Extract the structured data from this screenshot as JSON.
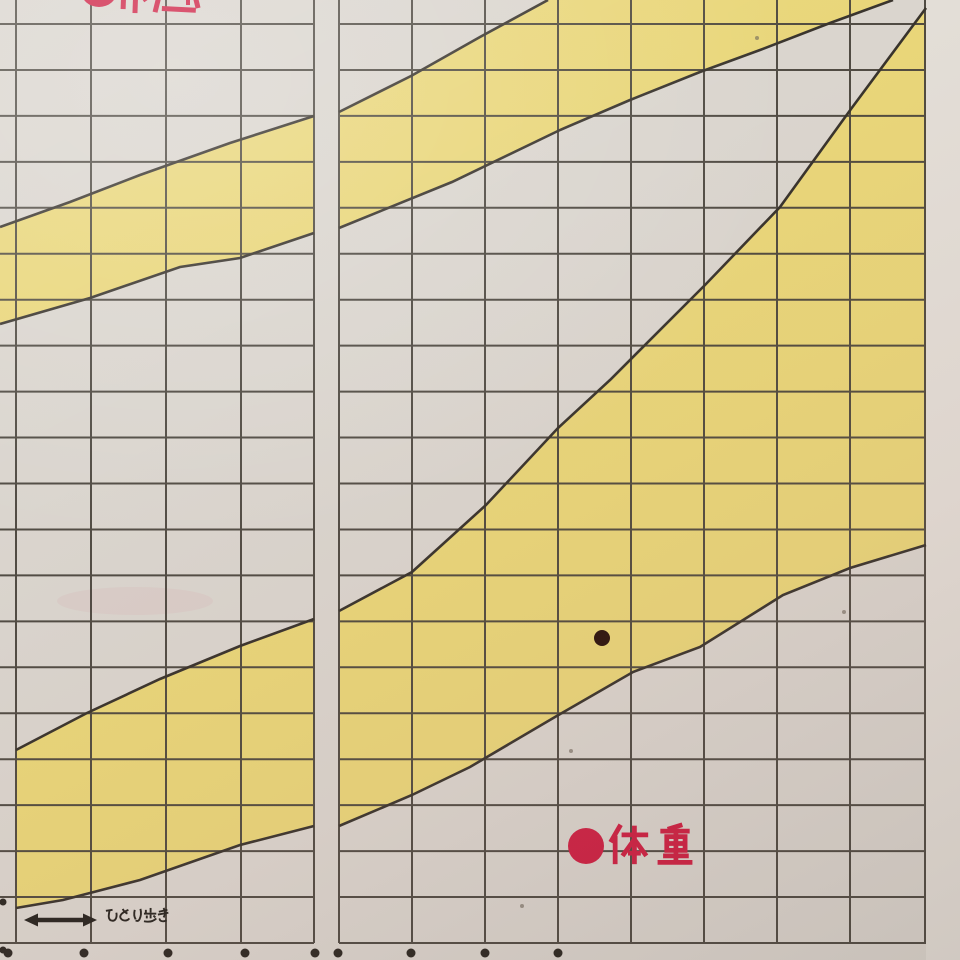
{
  "scene": {
    "description": "Photograph of a printed Japanese child growth chart page (percentile band chart)",
    "kind": "growth-chart-photo"
  },
  "labels": {
    "height_label": "●身長",
    "height_label_state": "cropped at top edge of photo, only bottom tips of red characters visible",
    "weight_bullet": "●",
    "weight_label": "体重",
    "walking_label": "ひとり歩き"
  },
  "colors": {
    "paper": "#dad5ce",
    "paper_margin": "#e3ded7",
    "band_yellow": "#e9d679",
    "grid_line": "#49443c",
    "band_edge": "#38332c",
    "accent_red": "#ce2043",
    "plot_dot": "#2a120b",
    "ink_dark": "#26231e",
    "tick_dot": "#2b2721",
    "smudge_pink": "#d46a7a"
  },
  "chart_data": {
    "type": "area",
    "title": "",
    "note": "Two diagonal yellow percentile bands: upper = height (身長), lower = weight (体重). One plotted measurement dot inside the weight band. Numeric axis labels fall outside the photo crop.",
    "units": "pixel coordinates in the 960x960 photo",
    "grid": {
      "h_line_y_start": 24,
      "h_line_y_end": 943,
      "h_line_count": 21,
      "left_panel_x": [
        16,
        91,
        166,
        241,
        314
      ],
      "right_panel_x": [
        339,
        412,
        485,
        558,
        631,
        704,
        777,
        850,
        925
      ],
      "panel_gap": [
        314,
        339
      ],
      "grid_left_edge": 0,
      "grid_right_edge": 926,
      "grid_bottom": 943
    },
    "series": [
      {
        "name": "height-band-left-panel",
        "fill": [
          [
            0,
            227
          ],
          [
            70,
            202
          ],
          [
            140,
            175
          ],
          [
            230,
            143
          ],
          [
            314,
            116
          ],
          [
            314,
            233
          ],
          [
            240,
            258
          ],
          [
            180,
            267
          ],
          [
            90,
            298
          ],
          [
            0,
            324
          ]
        ],
        "top_edge": [
          [
            0,
            227
          ],
          [
            70,
            202
          ],
          [
            140,
            175
          ],
          [
            230,
            143
          ],
          [
            314,
            116
          ]
        ],
        "bottom_edge": [
          [
            0,
            324
          ],
          [
            90,
            298
          ],
          [
            180,
            267
          ],
          [
            240,
            258
          ],
          [
            314,
            233
          ]
        ]
      },
      {
        "name": "height-band-right-panel",
        "fill": [
          [
            339,
            112
          ],
          [
            411,
            76
          ],
          [
            480,
            37
          ],
          [
            548,
            0
          ],
          [
            893,
            0
          ],
          [
            830,
            23
          ],
          [
            760,
            50
          ],
          [
            700,
            72
          ],
          [
            630,
            100
          ],
          [
            560,
            130
          ],
          [
            452,
            182
          ],
          [
            339,
            228
          ]
        ],
        "top_edge": [
          [
            339,
            112
          ],
          [
            411,
            76
          ],
          [
            480,
            37
          ],
          [
            548,
            0
          ]
        ],
        "bottom_edge": [
          [
            339,
            228
          ],
          [
            452,
            182
          ],
          [
            560,
            130
          ],
          [
            630,
            100
          ],
          [
            700,
            72
          ],
          [
            760,
            50
          ],
          [
            830,
            23
          ],
          [
            893,
            0
          ]
        ]
      },
      {
        "name": "weight-band-left-panel",
        "fill": [
          [
            16,
            750
          ],
          [
            87,
            713
          ],
          [
            160,
            679
          ],
          [
            240,
            646
          ],
          [
            314,
            619
          ],
          [
            314,
            826
          ],
          [
            240,
            845
          ],
          [
            140,
            880
          ],
          [
            63,
            900
          ],
          [
            16,
            908
          ]
        ],
        "top_edge": [
          [
            16,
            750
          ],
          [
            87,
            713
          ],
          [
            160,
            679
          ],
          [
            240,
            646
          ],
          [
            314,
            619
          ]
        ],
        "bottom_edge": [
          [
            16,
            908
          ],
          [
            63,
            900
          ],
          [
            140,
            880
          ],
          [
            240,
            845
          ],
          [
            314,
            826
          ]
        ]
      },
      {
        "name": "weight-band-right-panel",
        "fill": [
          [
            339,
            611
          ],
          [
            412,
            572
          ],
          [
            486,
            505
          ],
          [
            558,
            428
          ],
          [
            610,
            380
          ],
          [
            705,
            285
          ],
          [
            780,
            207
          ],
          [
            851,
            109
          ],
          [
            926,
            8
          ],
          [
            926,
            545
          ],
          [
            850,
            568
          ],
          [
            783,
            595
          ],
          [
            700,
            647
          ],
          [
            633,
            672
          ],
          [
            555,
            717
          ],
          [
            470,
            767
          ],
          [
            412,
            795
          ],
          [
            339,
            826
          ]
        ],
        "top_edge": [
          [
            339,
            611
          ],
          [
            412,
            572
          ],
          [
            486,
            505
          ],
          [
            558,
            428
          ],
          [
            610,
            380
          ],
          [
            705,
            285
          ],
          [
            780,
            207
          ],
          [
            851,
            109
          ],
          [
            926,
            8
          ]
        ],
        "bottom_edge": [
          [
            339,
            826
          ],
          [
            412,
            795
          ],
          [
            470,
            767
          ],
          [
            555,
            717
          ],
          [
            633,
            672
          ],
          [
            700,
            647
          ],
          [
            783,
            595
          ],
          [
            850,
            568
          ],
          [
            926,
            545
          ]
        ]
      }
    ],
    "plotted_point": {
      "x": 602,
      "y": 638,
      "radius": 8
    },
    "axis_tick_dots": {
      "y": 953,
      "radius": 4.5,
      "x": [
        8,
        84,
        168,
        245,
        315,
        338,
        411,
        485,
        558
      ]
    },
    "edge_marks": [
      [
        3,
        902
      ],
      [
        3,
        950
      ]
    ],
    "specks": [
      [
        844,
        612
      ],
      [
        571,
        751
      ],
      [
        757,
        38
      ],
      [
        522,
        906
      ]
    ],
    "smudges": [
      {
        "cx": 135,
        "cy": 601,
        "rx": 78,
        "ry": 14
      }
    ],
    "weight_label_pos": {
      "circle_cx": 586,
      "circle_cy": 846,
      "circle_r": 18,
      "text_x": 606,
      "text_y": 822,
      "char_box": 48,
      "char_size": 44,
      "advance": 47
    },
    "walking_annotation": {
      "arrow_x1": 24,
      "arrow_x2": 97,
      "arrow_y": 920,
      "text_x": 104,
      "text_y": 907,
      "char_box": 16,
      "char_scale": 0.95,
      "advance": 13
    },
    "height_label_stubs": [
      {
        "type": "ellipse",
        "cx": 99,
        "cy": -9,
        "rx": 18,
        "ry": 16
      },
      {
        "type": "rect",
        "x": 121,
        "y": -2,
        "w": 5,
        "h": 11,
        "rot": 2
      },
      {
        "type": "rect",
        "x": 133,
        "y": -2,
        "w": 5,
        "h": 15,
        "rot": 2
      },
      {
        "type": "rect",
        "x": 142,
        "y": -1,
        "w": 10,
        "h": 4,
        "rot": -35
      },
      {
        "type": "rect",
        "x": 156,
        "y": -2,
        "w": 5,
        "h": 14,
        "rot": 14
      },
      {
        "type": "rect",
        "x": 162,
        "y": 6,
        "w": 34,
        "h": 5,
        "rot": 3
      },
      {
        "type": "rect",
        "x": 186,
        "y": -2,
        "w": 4,
        "h": 7,
        "rot": 0
      },
      {
        "type": "rect",
        "x": 193,
        "y": -2,
        "w": 5,
        "h": 11,
        "rot": -14
      }
    ]
  }
}
